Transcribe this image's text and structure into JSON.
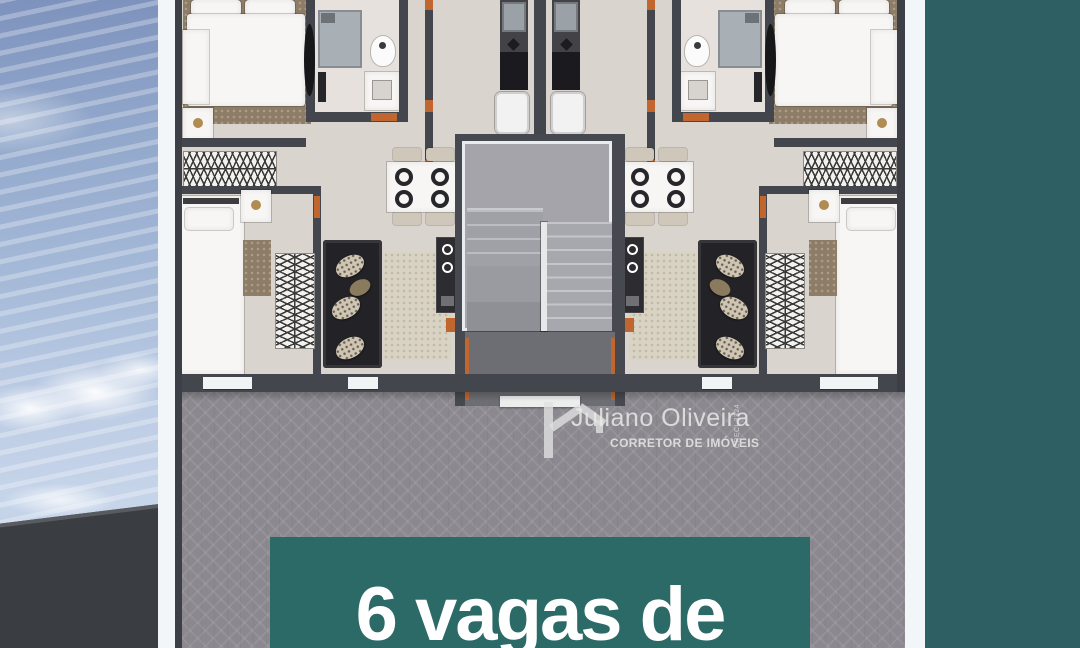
{
  "watermark": {
    "logo_icon": "house-icon",
    "name": "Juliano Oliveira",
    "title": "CORRETOR DE IMÓVEIS",
    "registration": "CRECI 3324"
  },
  "banner": {
    "text": "6 vagas de",
    "background_color": "#2c6a67",
    "text_color": "#ffffff"
  },
  "colors": {
    "background_teal": "#2e5f63",
    "frame_white": "#f3f6f8",
    "paving_gray": "#8b898f",
    "floor_beige": "#dad4cf",
    "wall_dark": "#43464c",
    "door_accent_orange": "#c1662f",
    "sky_blue": "#a7bbd9",
    "roof_charcoal": "#3a3d42"
  },
  "scene": {
    "left_panel": "sky with clouds above a dark roof edge",
    "main_panel": "top-down 3D floor plan of two mirrored apartments with central staircase, over gray herringbone paving"
  }
}
